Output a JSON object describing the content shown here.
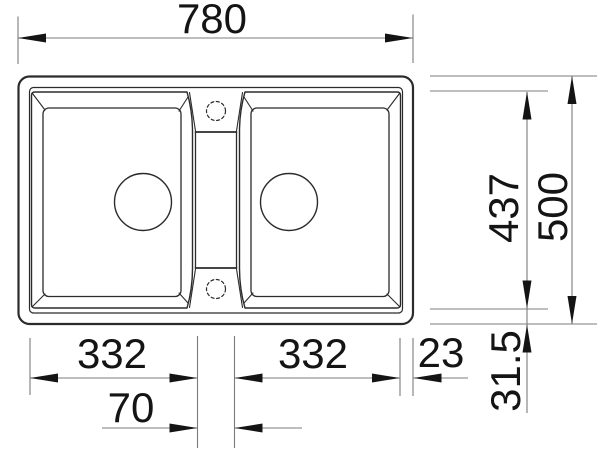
{
  "drawing": {
    "subject": "double-bowl-sink-top-view-dimension-drawing",
    "background_color": "#ffffff",
    "outline_color": "#2b2b2b",
    "dimension_line_color": "#7c7c7c",
    "dimension_text_color": "#141414",
    "dimensions": {
      "overall_width": "780",
      "overall_depth": "500",
      "cutline_depth": "437",
      "rim_inset": "31.5",
      "left_bowl_width": "332",
      "right_bowl_width": "332",
      "center_web_width": "70",
      "right_rim_width": "23"
    }
  }
}
